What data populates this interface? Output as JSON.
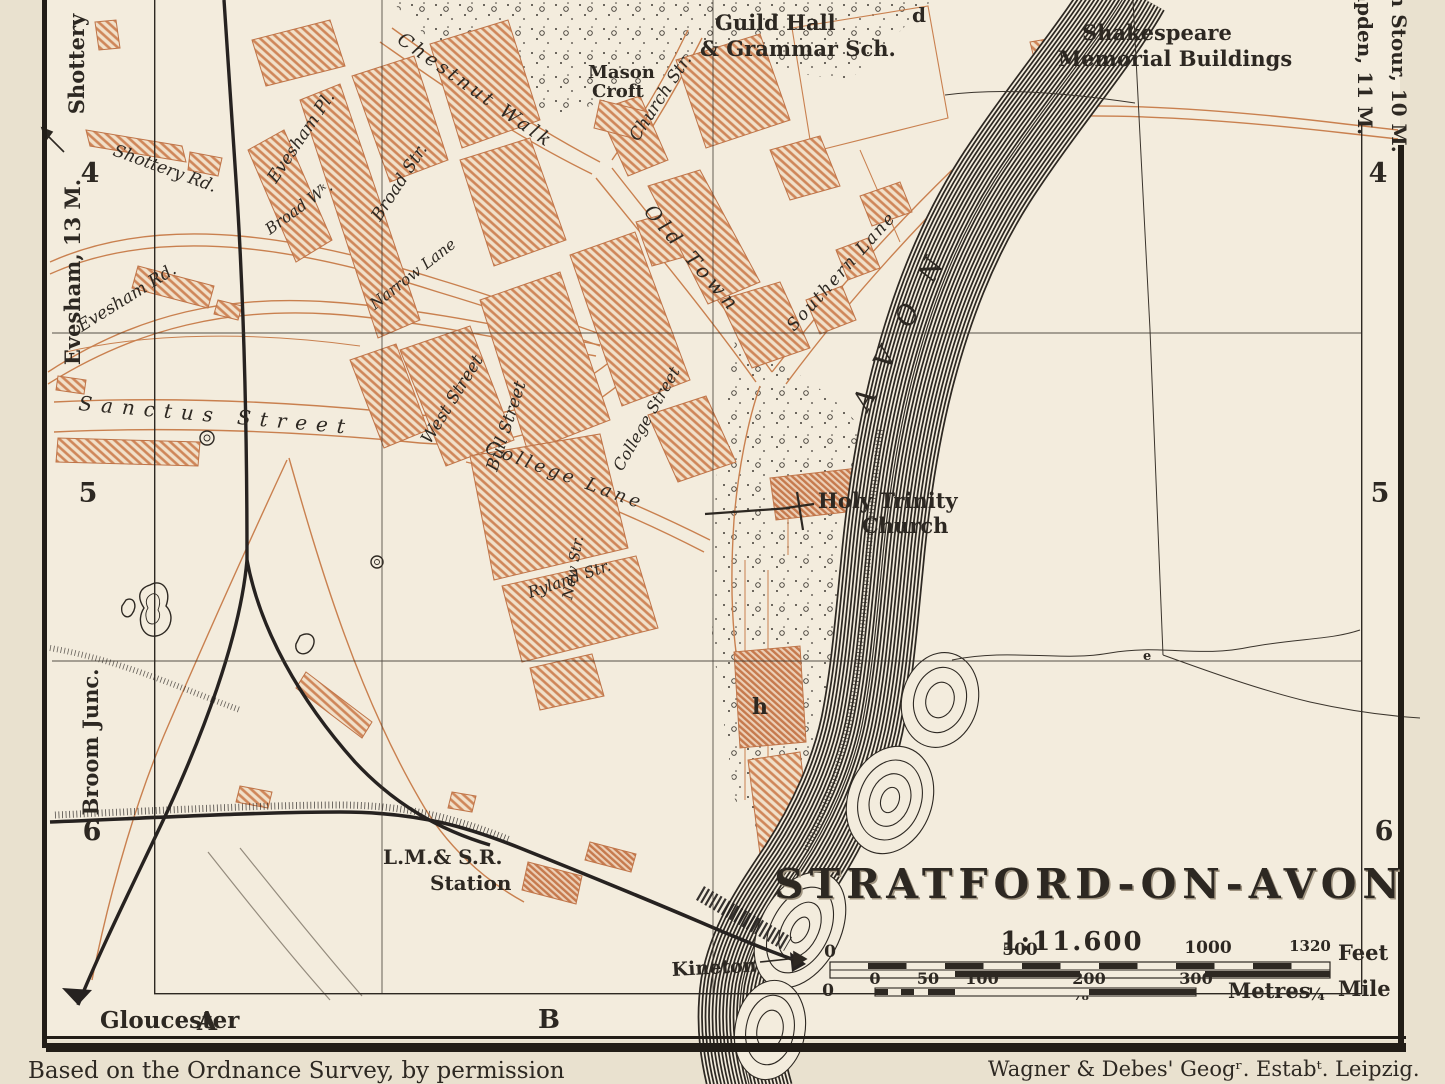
{
  "title_block": {
    "title": "STRATFORD-ON-AVON",
    "ratio": "1:11.600"
  },
  "credits": {
    "left": "Based on the Ordnance Survey, by permission",
    "right": "Wagner & Debes' Geogʳ. Estabᵗ. Leipzig."
  },
  "grid": {
    "rows": [
      "4",
      "5",
      "6"
    ],
    "cols": [
      "A",
      "B"
    ]
  },
  "margins": {
    "top_left": "Shottery",
    "left_upper": "Evesham, 13 M.",
    "left_lower": "Broom Junc.",
    "bottom_left": "Gloucester",
    "right_outer": "on Stour, 10 M.",
    "right_inner": "mpden, 11 M."
  },
  "labels": {
    "chestnut_walk": "Chestnut Walk",
    "church_str": "Church Str.",
    "broad_str": "Broad Str.",
    "evesham_pl": "Evesham Pl.",
    "broad_wk": "Broad Wᵏ.",
    "narrow_lane": "Narrow Lane",
    "west_street": "West Street",
    "bull_street": "Bull Street",
    "college_street": "College Street",
    "old_town": "Old Town",
    "southern_lane": "Southern Lane",
    "college_lane": "College Lane",
    "new_str": "New Str.",
    "ryland_str": "Ryland Str.",
    "sanctus_street": "Sanctus Street",
    "shottery_rd": "Shottery Rd.",
    "evesham_rd": "Evesham Rd.",
    "river": "AVON",
    "kineton": "Kineton",
    "guild_hall_1": "Guild Hall",
    "guild_hall_2": "& Grammar Sch.",
    "shakespeare_1": "Shakespeare",
    "shakespeare_2": "Memorial Buildings",
    "mason_1": "Mason",
    "mason_2": "Croft",
    "holy_1": "Holy Trinity",
    "holy_2": "Church",
    "station_1": "L.M.& S.R.",
    "station_2": "Station",
    "ref_d": "d",
    "ref_h": "h",
    "ref_e": "e"
  },
  "scalebar": {
    "feet_ticks": [
      "0",
      "500",
      "1000",
      "1320"
    ],
    "feet_unit": "Feet",
    "mile_zero": "0",
    "mile_eighth": "⅛",
    "mile_quarter": "¼",
    "mile_unit": "Mile",
    "metre_ticks": [
      "0",
      "50",
      "100",
      "200",
      "300"
    ],
    "metre_unit": "Metres"
  },
  "colors": {
    "ink": "#2d2822",
    "building": "#cf8659",
    "paper": "#f3ecdd"
  }
}
